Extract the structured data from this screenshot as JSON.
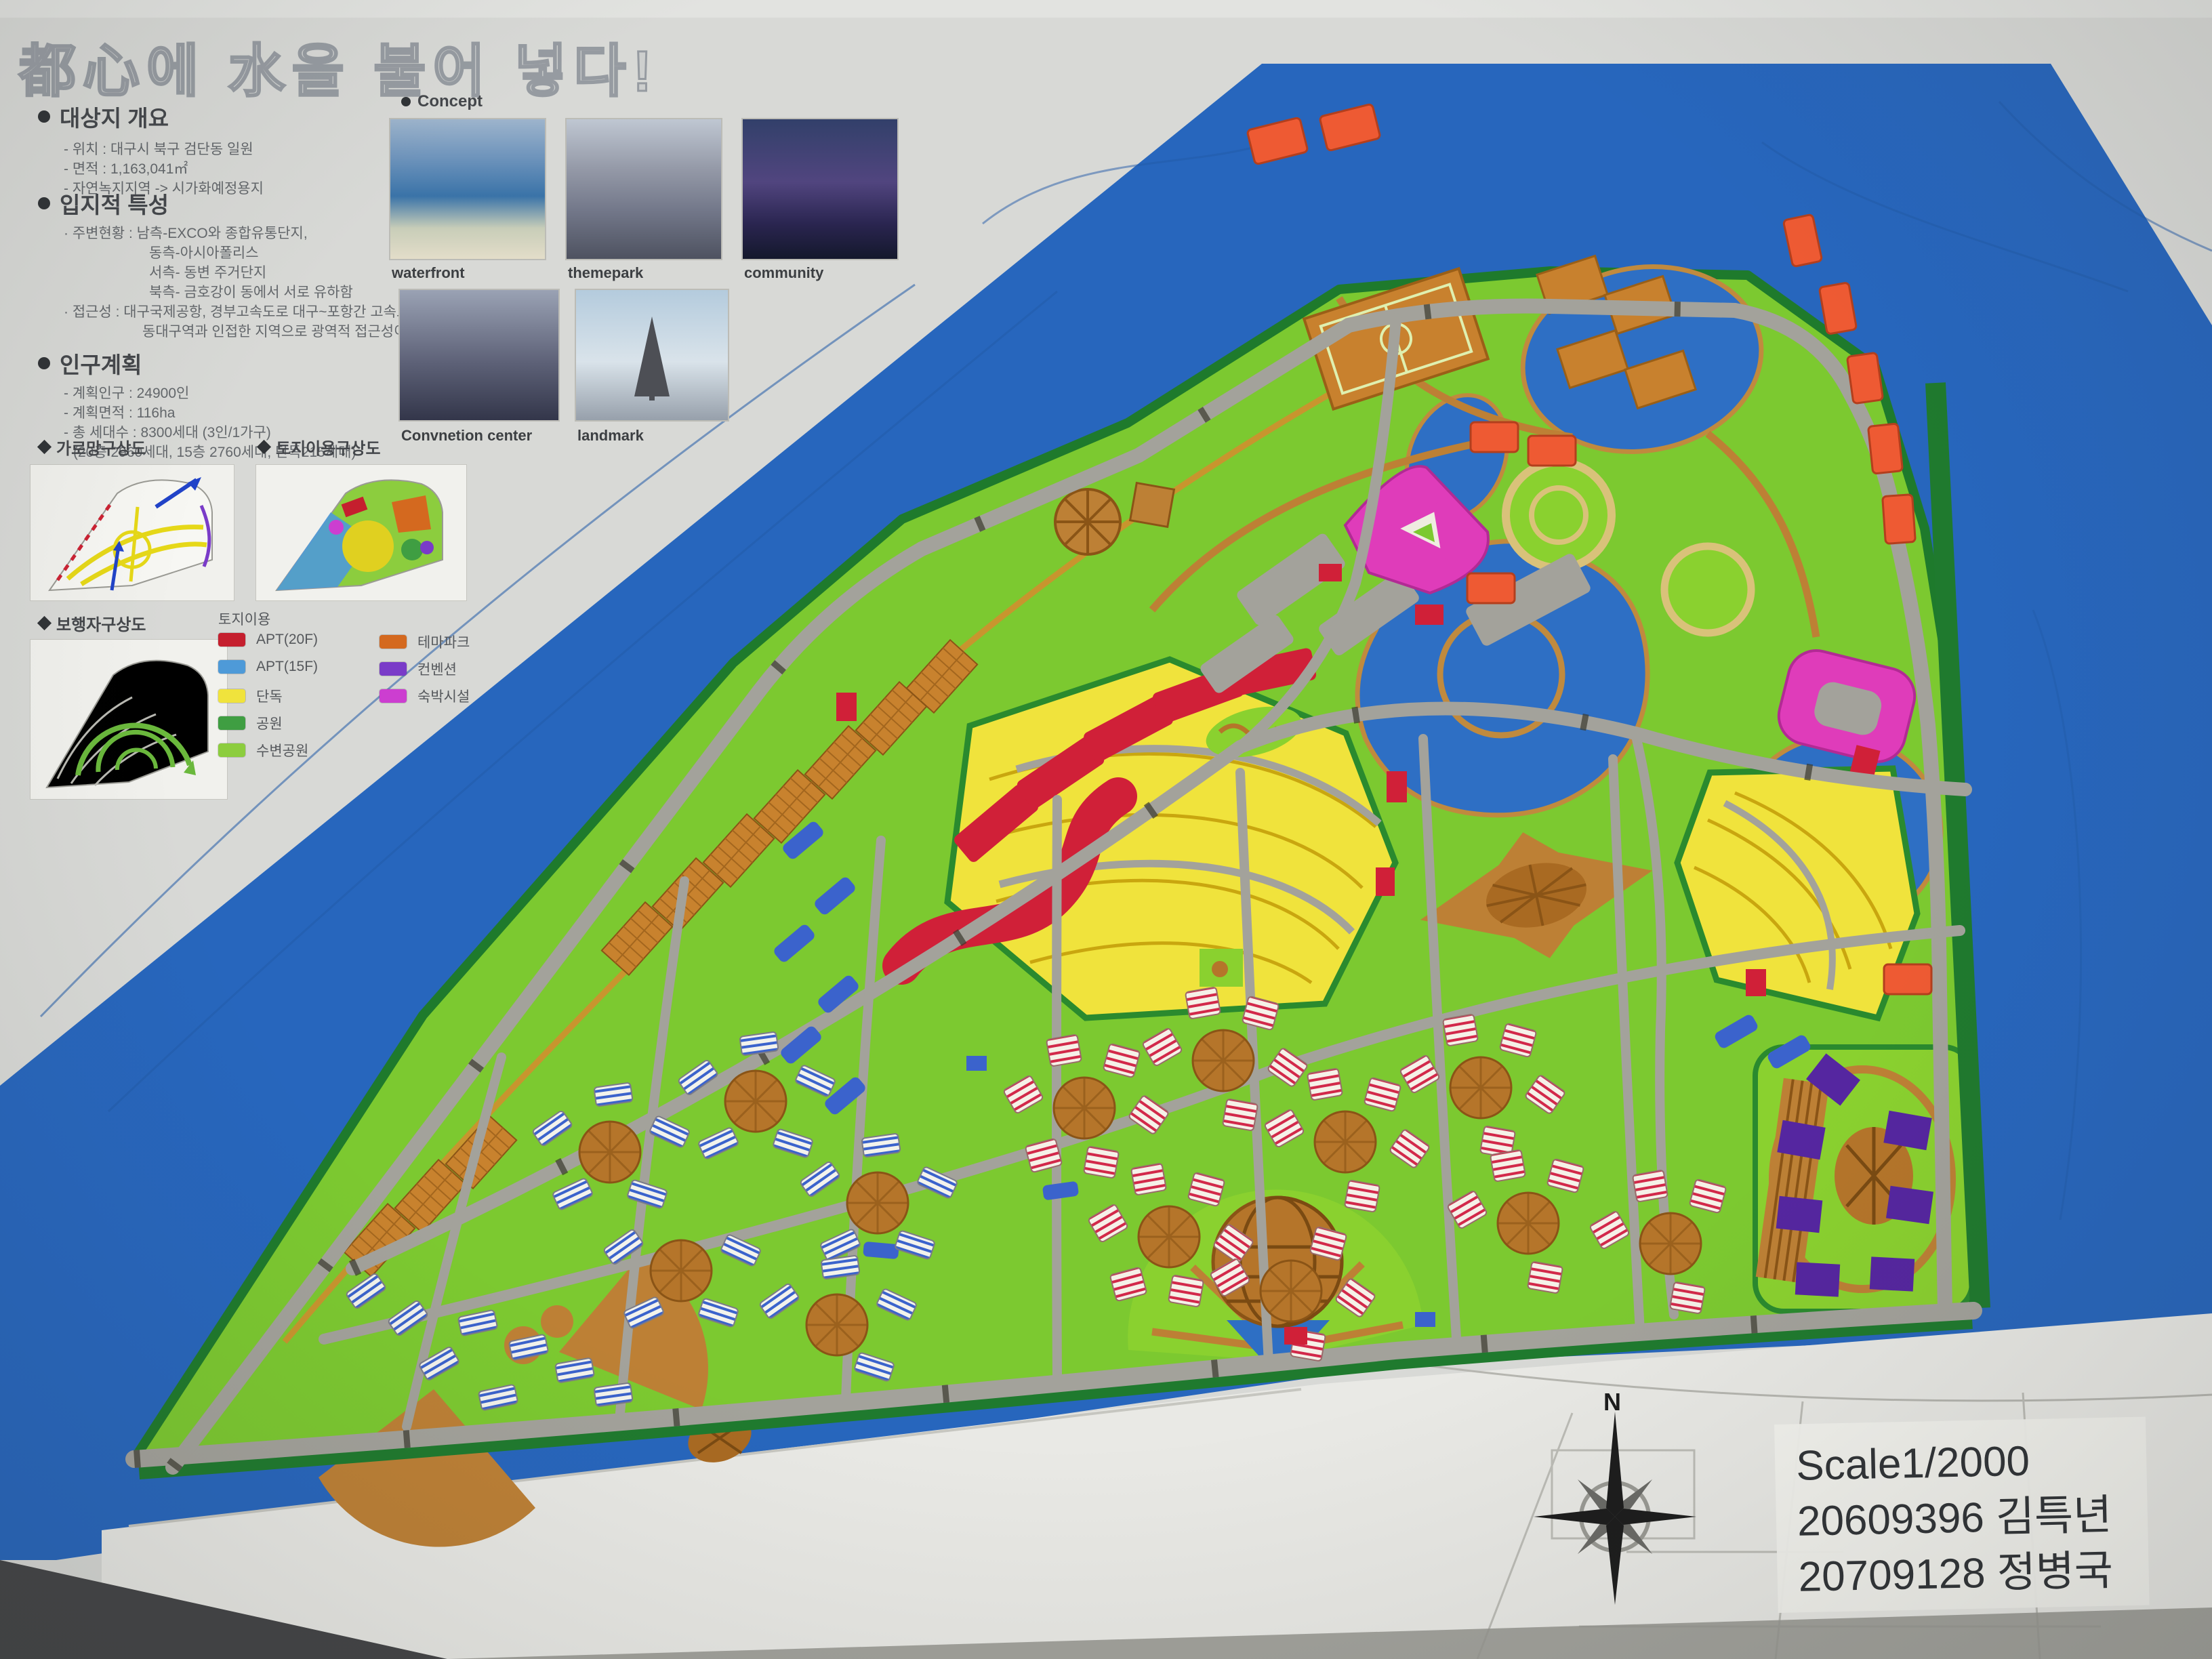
{
  "title": "都心에 水을 불어 넣다!",
  "overview": {
    "heading": "대상지 개요",
    "items": [
      "- 위치 : 대구시 북구 검단동 일원",
      "- 면적 : 1,163,041㎡",
      "- 자연녹지지역 -> 시가화예정용지"
    ]
  },
  "location": {
    "heading": "입지적 특성",
    "lines": [
      "· 주변현황 : 남측-EXCO와 종합유통단지,",
      "동측-아시아폴리스",
      "서측- 동변 주거단지",
      "북측- 금호강이 동에서 서로 유하함",
      "· 접근성 : 대구국제공항, 경부고속도로 대구~포항간 고속도로",
      "동대구역과 인접한 지역으로 광역적 접근성이 우수한 지역"
    ]
  },
  "population": {
    "heading": "인구계획",
    "items": [
      "- 계획인구 : 24900인",
      "- 계획면적 : 116ha",
      "- 총 세대수 : 8300세대 (3인/1가구)",
      "(20층 2960세대, 15층 2760세대, 단독215세대)",
      "- 인구밀도 : 214인/ha"
    ]
  },
  "concept": {
    "heading": "Concept",
    "images": [
      {
        "label": "waterfront"
      },
      {
        "label": "themepark"
      },
      {
        "label": "community"
      },
      {
        "label": "Convnetion center"
      },
      {
        "label": "landmark"
      }
    ]
  },
  "diagrams": {
    "d1": "가로망구상도",
    "d2": "토지이용구상도",
    "d3": "보행자구상도"
  },
  "legend": {
    "heading": "토지이용",
    "left": [
      {
        "label": "APT(20F)",
        "color": "#c51f2e"
      },
      {
        "label": "APT(15F)",
        "color": "#4e9ad8"
      },
      {
        "label": "단독",
        "color": "#f0e33c"
      },
      {
        "label": "공원",
        "color": "#3f9e42"
      },
      {
        "label": "수변공원",
        "color": "#8ccd3e"
      }
    ],
    "right": [
      {
        "label": "테마파크",
        "color": "#d4691f"
      },
      {
        "label": "컨벤션",
        "color": "#7a3bc8"
      },
      {
        "label": "숙박시설",
        "color": "#cc3ed0"
      }
    ]
  },
  "footer": {
    "compass": "N",
    "scale": "Scale1/2000",
    "credit1": "20609396 김특년",
    "credit2": "20709128 정병국"
  },
  "map_colors": {
    "water": "#2766bd",
    "land": "#7cc930",
    "road": "#a3a29b",
    "park_edge": "#1e7a2c",
    "path_brown": "#b5752a",
    "apt20": "#cf1f38",
    "apt15": "#3b63cc",
    "single_house": "#f0e33c",
    "themepark": "#ee5a33",
    "convention": "#5526a0",
    "lodging": "#df3cba"
  }
}
